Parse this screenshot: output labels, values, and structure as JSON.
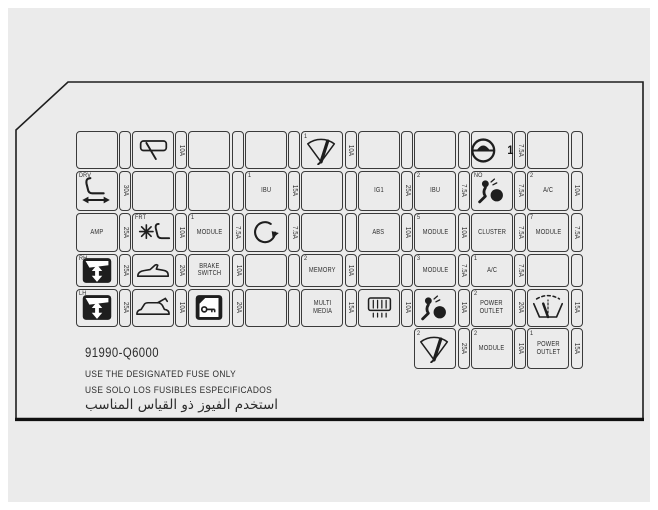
{
  "part_number": "91990-Q6000",
  "warnings": {
    "en": "USE THE DESIGNATED FUSE ONLY",
    "es": "USE SOLO LOS FUSIBLES ESPECIFICADOS",
    "ar": "استخدم الفيوز ذو القياس المناسب"
  },
  "colors": {
    "background": "#ebebeb",
    "line": "#3a3a3a",
    "text": "#2e2e2e",
    "accent": "#161616"
  },
  "grid": {
    "rows": [
      {
        "y": 131,
        "h": 38,
        "draw_empty": true,
        "cells": [
          null,
          {
            "icon": "rear-wiper-icon",
            "amp": "10A"
          },
          null,
          null,
          {
            "corner": "1",
            "icon": "front-wiper-icon",
            "amp": "10A"
          },
          null,
          null,
          {
            "icon": "steering-icon",
            "side": "1",
            "amp": "7.5A"
          },
          null
        ]
      },
      {
        "y": 170.5,
        "h": 40.5,
        "draw_empty": true,
        "cells": [
          {
            "corner": "DRV",
            "icon": "power-seat-icon",
            "amp": "30A"
          },
          null,
          null,
          {
            "corner": "1",
            "label": "IBU",
            "amp": "15A"
          },
          null,
          {
            "label": "IG1",
            "amp": "25A"
          },
          {
            "corner": "2",
            "label": "IBU",
            "amp": "7.5A"
          },
          {
            "corner": "NO",
            "icon": "airbag-icon",
            "amp": "7.5A"
          },
          {
            "corner": "2",
            "label": "A/C",
            "amp": "10A"
          }
        ]
      },
      {
        "y": 212.5,
        "h": 39.5,
        "draw_empty": true,
        "cells": [
          {
            "label": "AMP",
            "amp": "25A"
          },
          {
            "corner": "FRT",
            "icon": "seat-heater-icon",
            "amp": "10A"
          },
          {
            "corner": "1",
            "label": "MODULE",
            "amp": "7.5A"
          },
          {
            "icon": "rotate-arrow-icon",
            "amp": "7.5A"
          },
          null,
          {
            "label": "ABS",
            "amp": "10A"
          },
          {
            "corner": "5",
            "label": "MODULE",
            "amp": "10A"
          },
          {
            "label": "CLUSTER",
            "amp": "7.5A"
          },
          {
            "corner": "7",
            "label": "MODULE",
            "amp": "7.5A"
          }
        ]
      },
      {
        "y": 253.5,
        "h": 33.5,
        "draw_empty": true,
        "cells": [
          {
            "corner": "RH",
            "icon": "window-switch-icon",
            "amp": "25A"
          },
          {
            "icon": "convertible-icon",
            "amp": "20A"
          },
          {
            "label": "BRAKE\nSWITCH",
            "amp": "10A"
          },
          null,
          {
            "corner": "2",
            "label": "MEMORY",
            "amp": "10A"
          },
          null,
          {
            "corner": "3",
            "label": "MODULE",
            "amp": "7.5A"
          },
          {
            "corner": "1",
            "label": "A/C",
            "amp": "7.5A"
          },
          null
        ]
      },
      {
        "y": 288.5,
        "h": 38,
        "draw_empty": true,
        "cells": [
          {
            "corner": "LH",
            "icon": "window-switch-icon",
            "amp": "25A"
          },
          {
            "icon": "tailgate-icon",
            "amp": "10A"
          },
          {
            "icon": "door-lock-icon",
            "amp": "20A"
          },
          null,
          {
            "label": "MULTI\nMEDIA",
            "amp": "15A"
          },
          {
            "icon": "defogger-icon",
            "amp": "10A"
          },
          {
            "icon": "airbag-icon",
            "amp": "10A"
          },
          {
            "corner": "2",
            "label": "POWER\nOUTLET",
            "amp": "20A"
          },
          {
            "icon": "washer-icon",
            "amp": "15A"
          }
        ]
      },
      {
        "y": 328,
        "h": 41,
        "draw_empty": false,
        "cells": [
          null,
          null,
          null,
          null,
          null,
          null,
          {
            "corner": "2",
            "icon": "front-wiper-icon",
            "amp": "25A"
          },
          {
            "corner": "2",
            "label": "MODULE",
            "amp": "10A"
          },
          {
            "corner": "1",
            "label": "POWER\nOUTLET",
            "amp": "15A"
          }
        ]
      }
    ]
  }
}
